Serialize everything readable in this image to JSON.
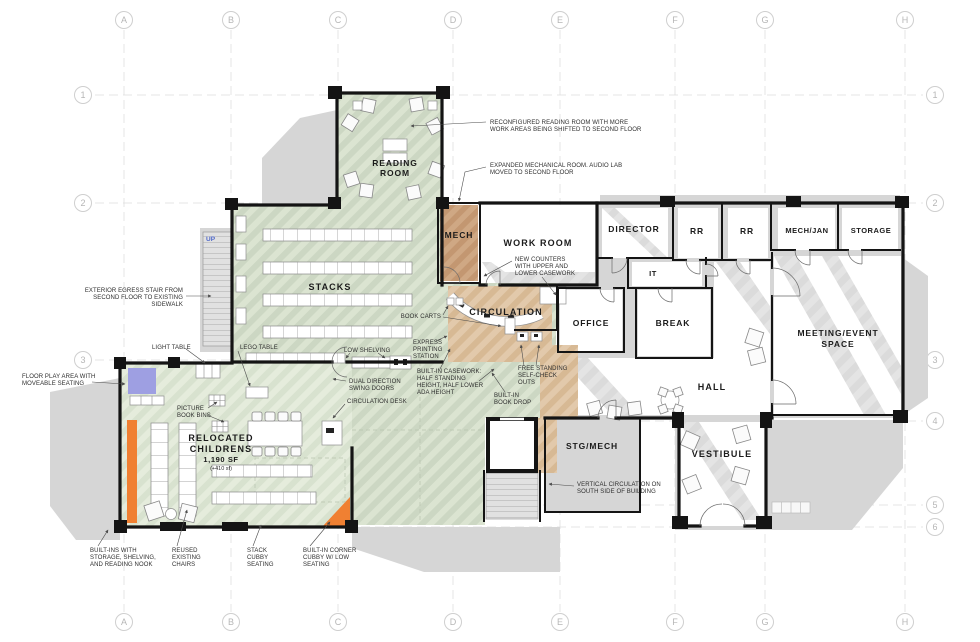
{
  "grid": {
    "columns": [
      "A",
      "B",
      "C",
      "D",
      "E",
      "F",
      "G",
      "H"
    ],
    "rows": [
      "1",
      "2",
      "3",
      "4",
      "5",
      "6"
    ]
  },
  "rooms": {
    "reading_room": {
      "lines": [
        "READING",
        "ROOM"
      ]
    },
    "stacks": {
      "lines": [
        "STACKS"
      ]
    },
    "mech": {
      "lines": [
        "MECH"
      ]
    },
    "work_room": {
      "lines": [
        "WORK ROOM"
      ]
    },
    "circulation": {
      "lines": [
        "CIRCULATION"
      ]
    },
    "director": {
      "lines": [
        "DIRECTOR"
      ]
    },
    "rr_1": {
      "lines": [
        "RR"
      ]
    },
    "rr_2": {
      "lines": [
        "RR"
      ]
    },
    "mech_jan": {
      "lines": [
        "MECH/JAN"
      ]
    },
    "storage": {
      "lines": [
        "STORAGE"
      ]
    },
    "it": {
      "lines": [
        "IT"
      ]
    },
    "office": {
      "lines": [
        "OFFICE"
      ]
    },
    "break_room": {
      "lines": [
        "BREAK"
      ]
    },
    "meeting": {
      "lines": [
        "MEETING/EVENT",
        "SPACE"
      ]
    },
    "hall": {
      "lines": [
        "HALL"
      ]
    },
    "vestibule": {
      "lines": [
        "VESTIBULE"
      ]
    },
    "stg_mech": {
      "lines": [
        "STG/MECH"
      ]
    },
    "childrens": {
      "lines": [
        "RELOCATED",
        "CHILDRENS"
      ],
      "area": "1,190 SF",
      "area_delta": "(+410 sf)"
    },
    "stair_up": "UP"
  },
  "annotations": {
    "reading_room_note": {
      "lines": [
        "RECONFIGURED READING ROOM WITH MORE",
        "WORK AREAS BEING SHIFTED TO SECOND FLOOR"
      ]
    },
    "mech_note": {
      "lines": [
        "EXPANDED MECHANICAL ROOM. AUDIO LAB",
        "MOVED TO SECOND FLOOR"
      ]
    },
    "counters_note": {
      "lines": [
        "NEW COUNTERS",
        "WITH UPPER AND",
        "LOWER CASEWORK"
      ]
    },
    "book_carts": {
      "lines": [
        "BOOK CARTS"
      ]
    },
    "express_printing": {
      "lines": [
        "EXPRESS",
        "PRINTING",
        "STATION"
      ]
    },
    "low_shelving": {
      "lines": [
        "LOW SHELVING"
      ]
    },
    "dual_doors": {
      "lines": [
        "DUAL DIRECTION",
        "SWING DOORS"
      ]
    },
    "circulation_desk": {
      "lines": [
        "CIRCULATION DESK"
      ]
    },
    "builtin_casework": {
      "lines": [
        "BUILT-IN CASEWORK:",
        "HALF STANDING",
        "HEIGHT, HALF LOWER",
        "ADA HEIGHT"
      ]
    },
    "self_check": {
      "lines": [
        "FREE STANDING",
        "SELF-CHECK",
        "OUTS"
      ]
    },
    "book_drop": {
      "lines": [
        "BUILT-IN",
        "BOOK DROP"
      ]
    },
    "egress_stair": {
      "lines": [
        "EXTERIOR EGRESS STAIR FROM",
        "SECOND FLOOR TO EXISTING",
        "SIDEWALK"
      ]
    },
    "light_table": {
      "lines": [
        "LIGHT TABLE"
      ]
    },
    "lego_table": {
      "lines": [
        "LEGO TABLE"
      ]
    },
    "floor_play": {
      "lines": [
        "FLOOR PLAY AREA WITH",
        "MOVEABLE SEATING"
      ]
    },
    "picture_bins": {
      "lines": [
        "PICTURE",
        "BOOK BINS"
      ]
    },
    "builtins_nook": {
      "lines": [
        "BUILT-INS WITH",
        "STORAGE, SHELVING,",
        "AND READING NOOK"
      ]
    },
    "reused_chairs": {
      "lines": [
        "REUSED",
        "EXISTING",
        "CHAIRS"
      ]
    },
    "stack_cubby": {
      "lines": [
        "STACK",
        "CUBBY",
        "SEATING"
      ]
    },
    "corner_cubby": {
      "lines": [
        "BUILT-IN CORNER",
        "CUBBY W/ LOW",
        "SEATING"
      ]
    },
    "vertical_circulation": {
      "lines": [
        "VERTICAL CIRCULATION ON",
        "SOUTH SIDE OF BUILDING"
      ]
    }
  },
  "colors": {
    "new_program_green": "#ccd7c3",
    "childrens_green": "#d8e2cf",
    "circulation_tan": "#e2c9ab",
    "mech_tan": "#cfa884",
    "accent_orange": "#f08032",
    "play_area_purple": "#9e9fe2",
    "existing_gray": "#d6d6d6",
    "wall_black": "#141414"
  }
}
